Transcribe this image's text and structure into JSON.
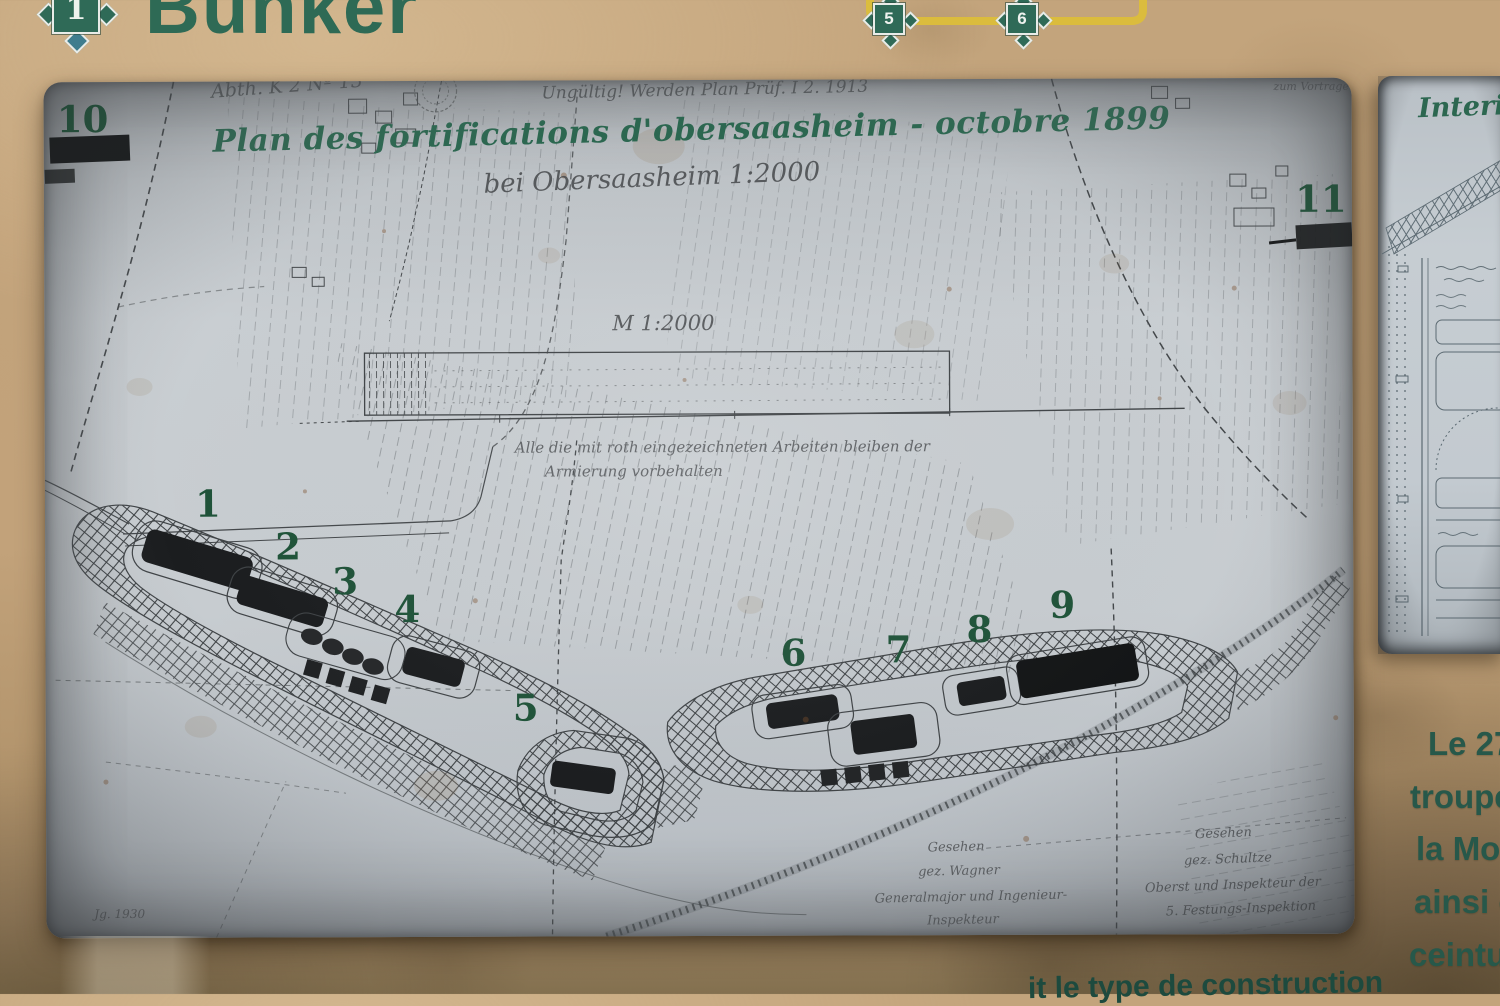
{
  "header": {
    "badge_number": "1",
    "title": "Bunker"
  },
  "trail": {
    "badge5": "5",
    "badge6": "6"
  },
  "map": {
    "title": "Plan des fortifications d'obersaasheim - octobre 1899",
    "subtitle_handwritten": "bei Obersaasheim  1:2000",
    "scale_note": "M  1:2000",
    "top_left_note": "Abth. K 2  Nº 13",
    "top_center_note": "Ungültig!  Werden Plan Prüf. I 2. 1913",
    "top_right_note": "zum Vortrage",
    "armierung_note_line1": "Alle die mit roth eingezeichneten Arbeiten bleiben der",
    "armierung_note_line2": "Armierung vorbehalten",
    "year_note": "Jg. 1930",
    "markers": [
      "1",
      "2",
      "3",
      "4",
      "5",
      "6",
      "7",
      "8",
      "9",
      "10",
      "11"
    ],
    "signatures_left": [
      "Gesehen",
      "gez. Wagner",
      "Generalmajor und Ingenieur-",
      "Inspekteur"
    ],
    "signatures_right": [
      "Gesehen",
      "gez. Schultze",
      "Oberst und Inspekteur der",
      "5. Festungs-Inspektion"
    ]
  },
  "right_panel": {
    "title": "Interie"
  },
  "side_text": {
    "lines": [
      "Le 27/",
      "troupes",
      "la Mose",
      "ainsi qu",
      "ceinture"
    ]
  },
  "bottom_text": {
    "fragment": "it le type de construction"
  },
  "colors": {
    "board_tan": "#c1a37b",
    "map_paper": "#c6cbcf",
    "map_ink": "#3f4346",
    "heading_green": "#2e6a55",
    "map_title_green": "#2c6750",
    "marker_green": "#1e5238",
    "trail_yellow": "#dcbe3a",
    "side_text_green": "#27584a"
  }
}
